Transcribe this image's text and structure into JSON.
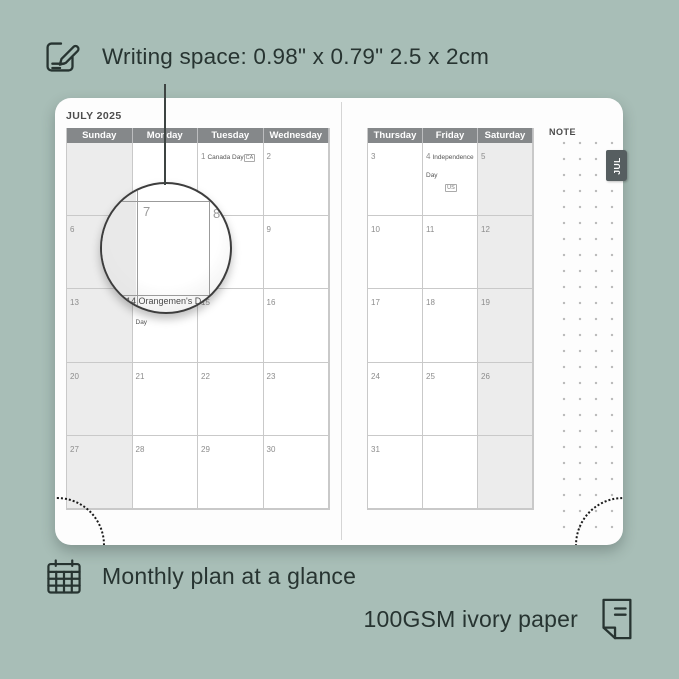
{
  "colors": {
    "background": "#a8beb7",
    "ink": "#273431",
    "page": "#fdfdfd",
    "header_bg": "#85888a",
    "shaded_cell": "#ececec",
    "grid_line": "#c9c9c9",
    "tab_bg": "#565e60"
  },
  "annotations": {
    "writing_space": "Writing space: 0.98\" x 0.79\" 2.5 x 2cm",
    "monthly_plan": "Monthly plan at a glance",
    "paper": "100GSM ivory paper"
  },
  "icons": {
    "top_left": "pencil-note-icon",
    "bottom_left": "calendar-grid-icon",
    "bottom_right": "paper-sheet-icon"
  },
  "planner": {
    "month_title": "JULY 2025",
    "tab_label": "JUL",
    "note_label": "NOTE",
    "magnifier": {
      "left_day": "7",
      "right_day": "8",
      "bottom_text": "14 Orangemen's D"
    },
    "left_page": {
      "headers": [
        "Sunday",
        "Monday",
        "Tuesday",
        "Wednesday"
      ],
      "shaded_column": 0,
      "rows": [
        [
          {
            "day": ""
          },
          {
            "day": ""
          },
          {
            "day": "1",
            "event": "Canada Day",
            "badge": "CA",
            "badge_layout": "inline"
          },
          {
            "day": "2"
          }
        ],
        [
          {
            "day": "6"
          },
          {
            "day": "7"
          },
          {
            "day": "8"
          },
          {
            "day": "9"
          }
        ],
        [
          {
            "day": "13"
          },
          {
            "day": "14",
            "event": "Orangemen's Day"
          },
          {
            "day": "15"
          },
          {
            "day": "16"
          }
        ],
        [
          {
            "day": "20"
          },
          {
            "day": "21"
          },
          {
            "day": "22"
          },
          {
            "day": "23"
          }
        ],
        [
          {
            "day": "27"
          },
          {
            "day": "28"
          },
          {
            "day": "29"
          },
          {
            "day": "30"
          }
        ]
      ]
    },
    "right_page": {
      "headers": [
        "Thursday",
        "Friday",
        "Saturday"
      ],
      "shaded_column": 2,
      "rows": [
        [
          {
            "day": "3"
          },
          {
            "day": "4",
            "event": "Independence Day",
            "badge": "US",
            "badge_layout": "block"
          },
          {
            "day": "5"
          }
        ],
        [
          {
            "day": "10"
          },
          {
            "day": "11"
          },
          {
            "day": "12"
          }
        ],
        [
          {
            "day": "17"
          },
          {
            "day": "18"
          },
          {
            "day": "19"
          }
        ],
        [
          {
            "day": "24"
          },
          {
            "day": "25"
          },
          {
            "day": "26"
          }
        ],
        [
          {
            "day": "31"
          },
          {
            "day": ""
          },
          {
            "day": ""
          }
        ]
      ]
    }
  }
}
